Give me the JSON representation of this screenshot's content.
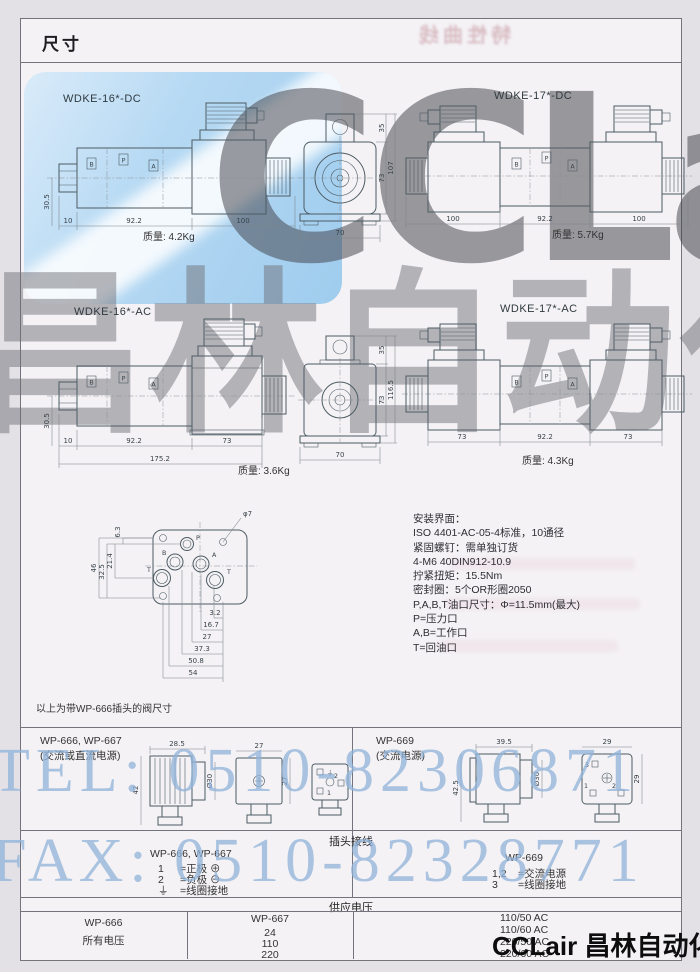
{
  "page": {
    "header_title": "尺寸",
    "footer_brand": "CCLair 昌林自动化",
    "showthrough_title": "特性曲线"
  },
  "watermarks": {
    "brand": "CCLair",
    "brand_cn": "昌林自动化",
    "tel": "TEL: 0510-82306871",
    "fax": "FAX: 0510-82328771"
  },
  "ports": [
    "B",
    "P",
    "A"
  ],
  "valves": {
    "dc16": {
      "label": "WDKE-16*-DC",
      "weight": "质量: 4.2Kg",
      "dim_left": "30.5",
      "dim_a": "10",
      "dim_b": "92.2",
      "dim_c": "100"
    },
    "dc17": {
      "label": "WDKE-17*-DC",
      "weight": "质量: 5.7Kg",
      "dim_a": "100",
      "dim_b": "92.2",
      "dim_c": "100"
    },
    "ac16": {
      "label": "WDKE-16*-AC",
      "weight": "质量: 3.6Kg",
      "dim_left": "30.5",
      "dim_a": "10",
      "dim_b": "92.2",
      "dim_c": "73",
      "dim_total": "175.2"
    },
    "ac17": {
      "label": "WDKE-17*-AC",
      "weight": "质量: 4.3Kg",
      "dim_a": "73",
      "dim_b": "92.2",
      "dim_c": "73"
    },
    "end_dc": {
      "dim_top": "35",
      "dim_total": "107",
      "dim_body": "73",
      "dim_width": "70"
    },
    "end_ac": {
      "dim_top": "35",
      "dim_total": "116.5",
      "dim_body": "73",
      "dim_width": "70"
    }
  },
  "mounting": {
    "note": "以上为带WP-666插头的阀尺寸",
    "hole_label": "φ7",
    "port_p": "P",
    "port_a": "A",
    "port_b": "B",
    "port_t1": "T",
    "port_t2": "T",
    "dims_vertical": [
      "46",
      "32.5",
      "21.4",
      "6.3"
    ],
    "dims_horizontal": [
      "3.2",
      "16.7",
      "27",
      "37.3",
      "50.8",
      "54"
    ],
    "info_lines": [
      "安装界面：",
      "ISO 4401-AC-05-4标准，10通径",
      "紧固螺钉：需单独订货",
      "4-M6 40DIN912-10.9",
      "拧紧扭矩：15.5Nm",
      "密封圈：5个OR形圈2050",
      "P,A,B,T油口尺寸：Φ=11.5mm(最大)",
      "P=压力口",
      "A,B=工作口",
      "T=回油口"
    ]
  },
  "plugs": {
    "left": {
      "title": "WP-666, WP-667",
      "subtitle": "(交流或直流电源)",
      "dim_w": "28.5",
      "dim_h": "42",
      "dim_d": "Ø30",
      "dim_fw": "27",
      "dim_fh": "27",
      "pin1": "1",
      "pin2": "2",
      "pin3": "⏚"
    },
    "right": {
      "title": "WP-669",
      "subtitle": "(交流电源)",
      "dim_w": "39.5",
      "dim_h": "42.5",
      "dim_d": "Ø30",
      "dim_fw": "29",
      "dim_fh": "29",
      "pin1": "1",
      "pin2": "2",
      "pin3": "3"
    }
  },
  "wiring": {
    "title": "插头接线",
    "left_header": "WP-666, WP-667",
    "left_rows": [
      {
        "pin": "1",
        "desc": "=正极 ⊕"
      },
      {
        "pin": "2",
        "desc": "=负极 ⊖"
      },
      {
        "pin": "⏚",
        "desc": "=线圈接地"
      }
    ],
    "right_header": "WP-669",
    "right_rows": [
      {
        "pin": "1,2",
        "desc": "=交流电源"
      },
      {
        "pin": "3",
        "desc": "=线圈接地"
      }
    ]
  },
  "voltage": {
    "title": "供应电压",
    "col1_header": "WP-666",
    "col1_value": "所有电压",
    "col2_header": "WP-667",
    "col2_values": [
      "24",
      "110",
      "220"
    ],
    "col3_values": [
      "110/50 AC",
      "110/60 AC",
      "220/50 AC",
      "220/60 AC"
    ]
  }
}
